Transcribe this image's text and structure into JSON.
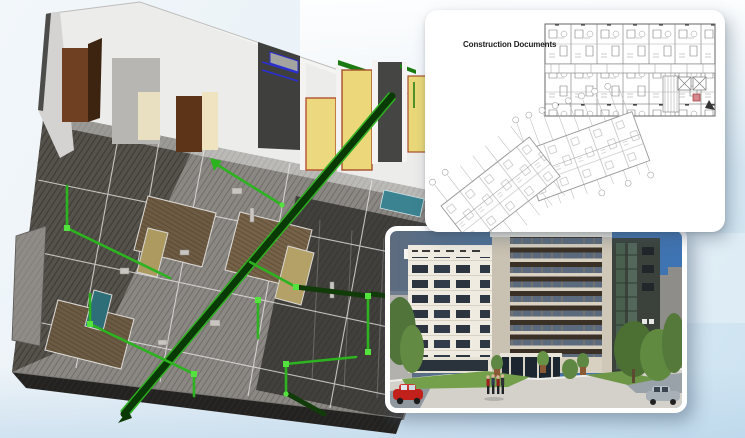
{
  "cards": {
    "documents": {
      "title": "Construction Documents"
    }
  },
  "colors": {
    "background_top": "#f2f7fa",
    "background_bottom": "#cde3f1",
    "pipe_green_bright": "#2cb31f",
    "pipe_green_dark": "#0a3a04",
    "floor_gray": "#8b8884",
    "wall_white": "#ececea",
    "door_yellow": "#ecd87b",
    "door_brown": "#6f4122",
    "door_teal": "#3b8391",
    "duct_blue": "#2b2fd6",
    "plan_line": "#777777",
    "plan_highlight_red": "#c05a62",
    "sky_blue": "#3e74b4",
    "facade_cream": "#efebe1",
    "facade_beige": "#d8d0c1",
    "glass_dark": "#2c3440",
    "tree_green": "#5f8a40",
    "grass_green": "#74a04c",
    "car_red": "#c2201a",
    "car_silver": "#a7b0b6"
  }
}
